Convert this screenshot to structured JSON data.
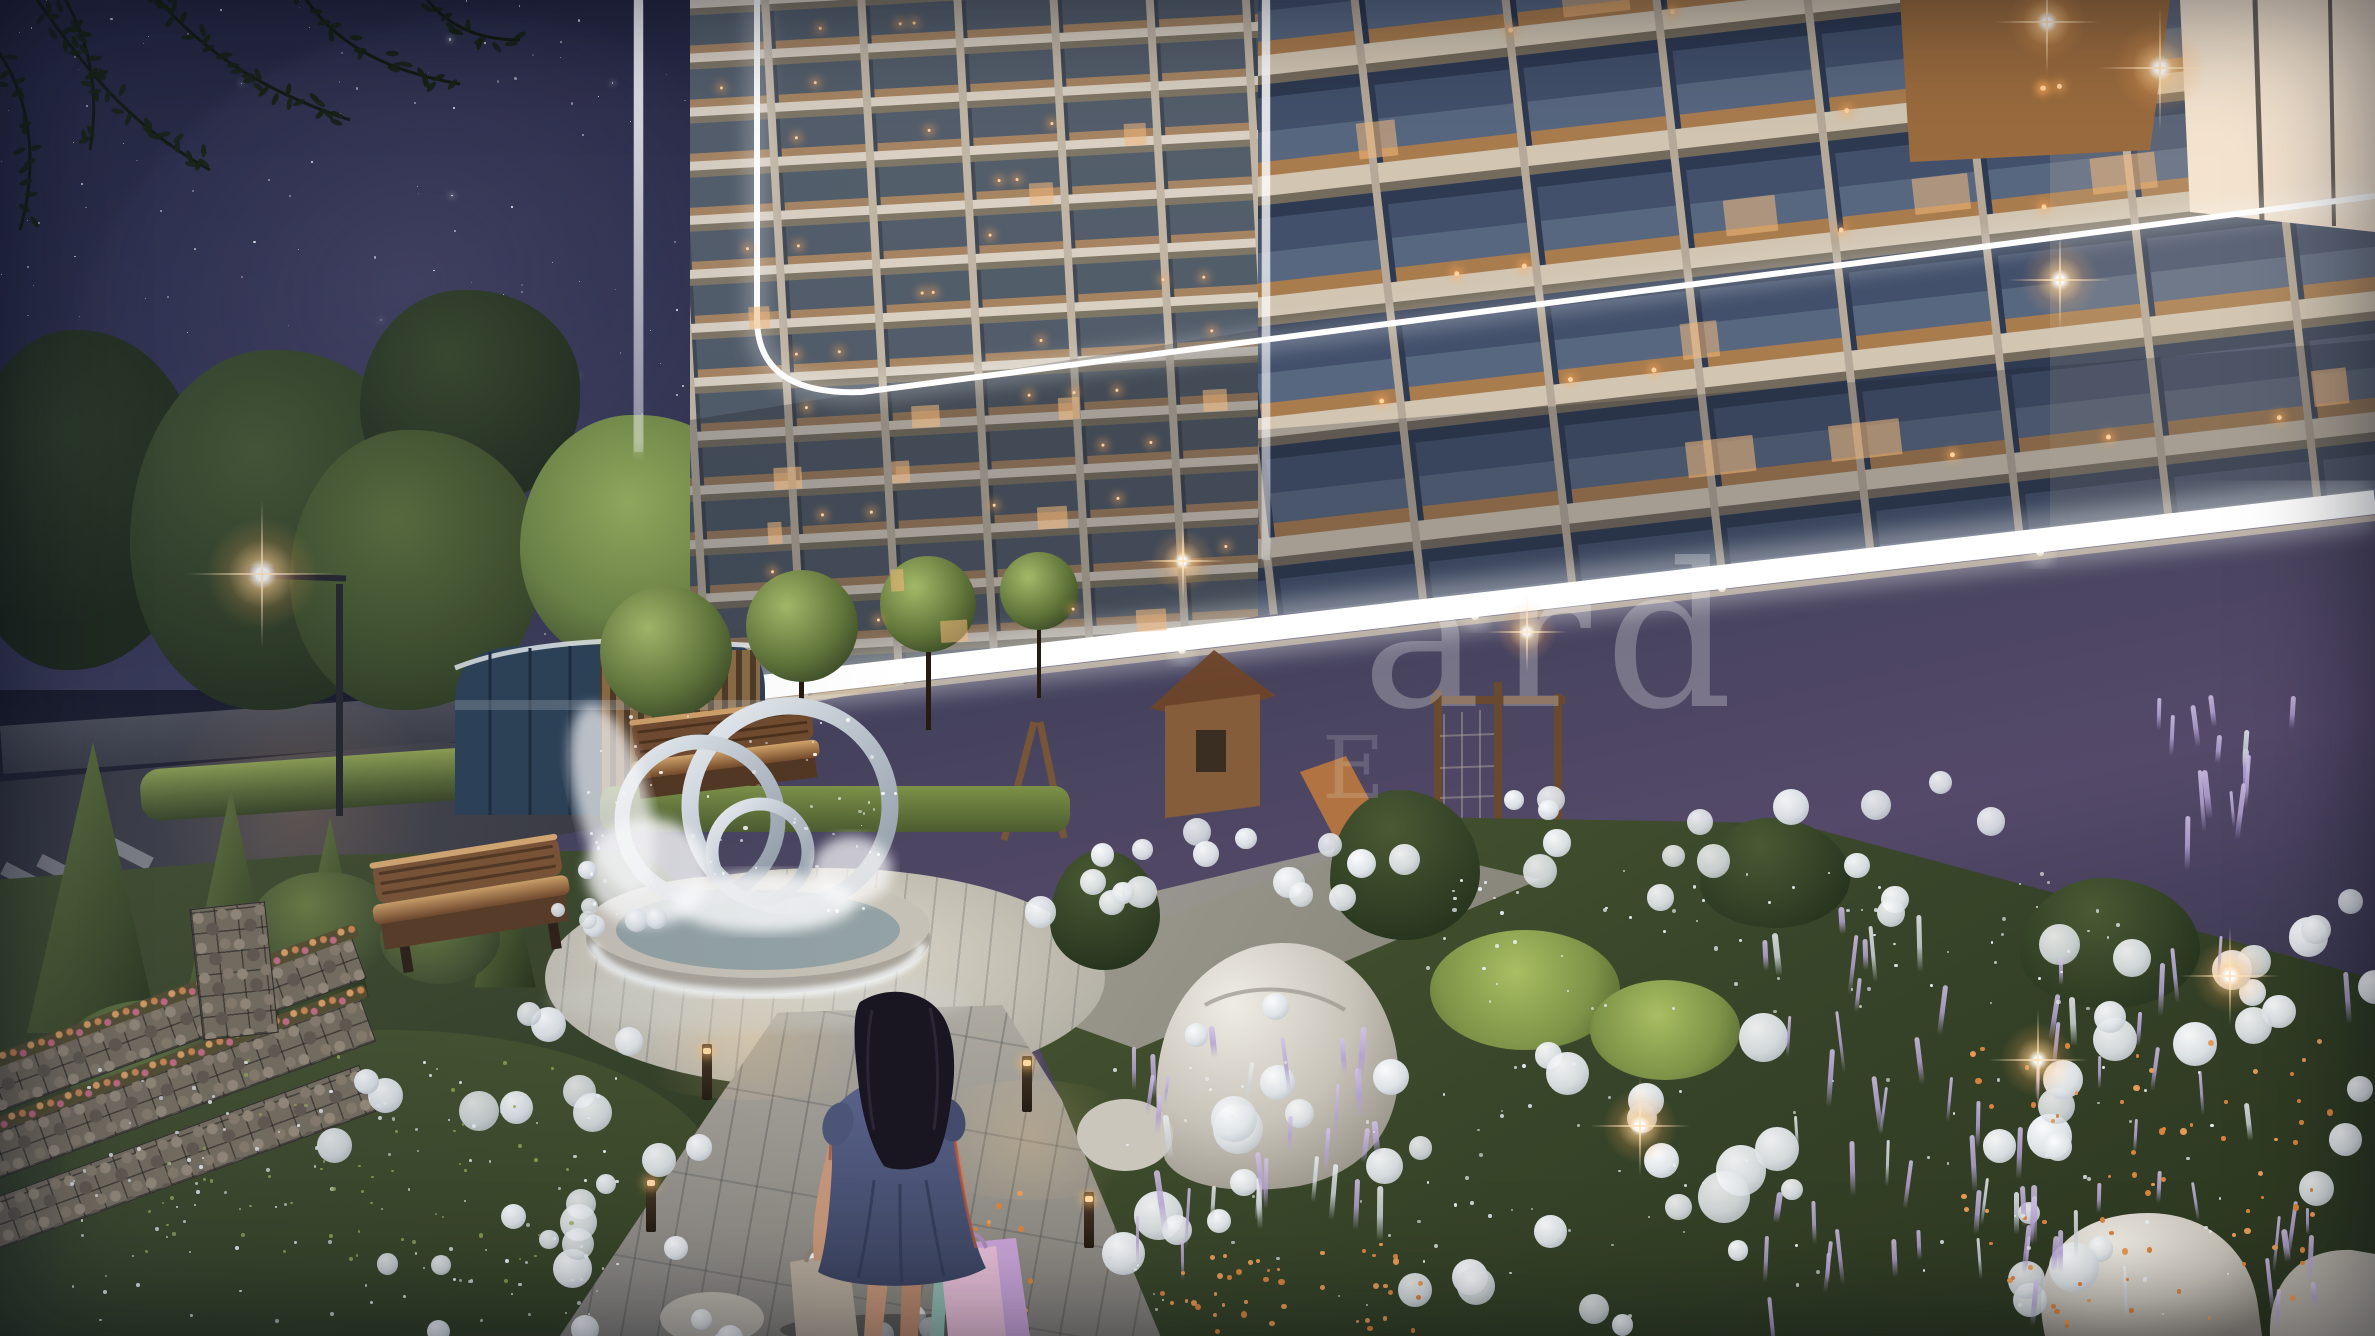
{
  "watermark": {
    "line1": "ard",
    "line2": "E"
  },
  "cafe": {
    "word_wall_text": "COFFEE"
  },
  "colors": {
    "sky_top": "#23243e",
    "sky_horizon": "#55496a",
    "led_white": "#ffffff",
    "warm_light": "#ffc687",
    "facade_beige": "#c3b7a6",
    "glass_dark": "#33405b",
    "canopy_glow": "#fff6df",
    "garden_green": "#3c4a2b",
    "flower_white": "#eef1f2",
    "flower_purple": "#c3b2e0",
    "flower_orange": "#d5803f",
    "path_grey": "#9aa0a6",
    "dress_navy": "#4a5470",
    "bag_pink": "#d6a3c4",
    "bag_grey": "#aba294",
    "hair_dark": "#17141a",
    "cafe_pink": "#dfa79c",
    "coffee_wall": "#3f2c26",
    "wood_warm": "#a97f52"
  }
}
